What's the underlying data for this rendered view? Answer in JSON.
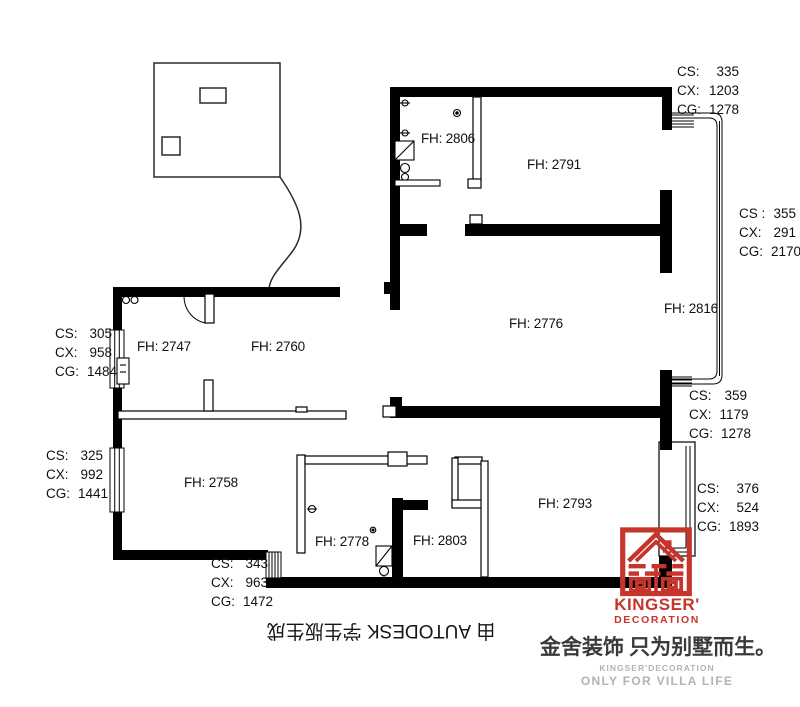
{
  "watermark": {
    "text": "由 AUTODESK 学生版生成"
  },
  "rooms": [
    {
      "label": "FH: 2806"
    },
    {
      "label": "FH: 2791"
    },
    {
      "label": "FH: 2776"
    },
    {
      "label": "FH: 2816"
    },
    {
      "label": "FH: 2747"
    },
    {
      "label": "FH: 2760"
    },
    {
      "label": "FH: 2758"
    },
    {
      "label": "FH: 2778"
    },
    {
      "label": "FH: 2803"
    },
    {
      "label": "FH: 2793"
    }
  ],
  "dimensions": [
    {
      "id": "top-right",
      "rows": [
        {
          "k": "CS:",
          "v": "335"
        },
        {
          "k": "CX:",
          "v": "1203"
        },
        {
          "k": "CG:",
          "v": "1278"
        }
      ]
    },
    {
      "id": "right-upper",
      "rows": [
        {
          "k": "CS :",
          "v": "355"
        },
        {
          "k": "CX:",
          "v": "291"
        },
        {
          "k": "CG:",
          "v": "2170"
        }
      ]
    },
    {
      "id": "right-middle",
      "rows": [
        {
          "k": "CS:",
          "v": "359"
        },
        {
          "k": "CX:",
          "v": "1179"
        },
        {
          "k": "CG:",
          "v": "1278"
        }
      ]
    },
    {
      "id": "right-lower",
      "rows": [
        {
          "k": "CS:",
          "v": "376"
        },
        {
          "k": "CX:",
          "v": "524"
        },
        {
          "k": "CG:",
          "v": "1893"
        }
      ]
    },
    {
      "id": "left-upper",
      "rows": [
        {
          "k": "CS:",
          "v": "305"
        },
        {
          "k": "CX:",
          "v": "958"
        },
        {
          "k": "CG:",
          "v": "1484"
        }
      ]
    },
    {
      "id": "left-lower",
      "rows": [
        {
          "k": "CS:",
          "v": "325"
        },
        {
          "k": "CX:",
          "v": "992"
        },
        {
          "k": "CG:",
          "v": "1441"
        }
      ]
    },
    {
      "id": "bottom",
      "rows": [
        {
          "k": "CS:",
          "v": "343"
        },
        {
          "k": "CX:",
          "v": "963"
        },
        {
          "k": "CG:",
          "v": "1472"
        }
      ]
    }
  ],
  "branding": {
    "logo_title": "KINGSER'",
    "logo_subtitle": "DECORATION",
    "slogan_cn": "金舍装饰 只为别墅而生。",
    "slogan_en_small": "KINGSER'DECORATION",
    "slogan_en": "ONLY FOR VILLA LIFE"
  },
  "colors": {
    "wall_black": "#000000",
    "brand_red": "#c6352c",
    "muted_gray": "#b3b3b3",
    "text_dark": "#161616"
  }
}
